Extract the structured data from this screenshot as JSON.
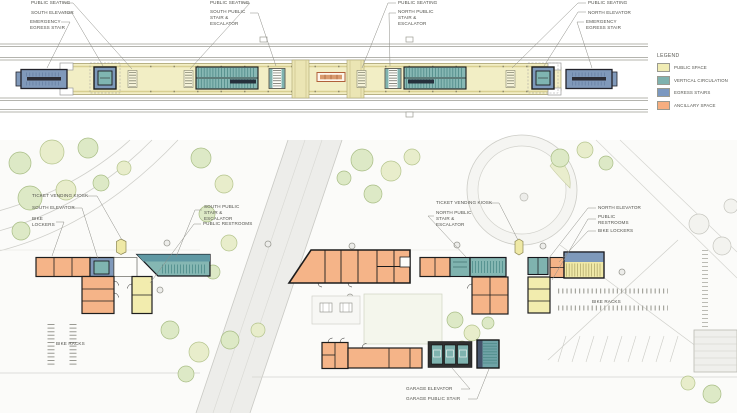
{
  "title": "Transit station plans — platform level and street level",
  "legend": {
    "title": "LEGEND",
    "items": [
      {
        "label": "PUBLIC SPACE",
        "color": "#f0ecb4"
      },
      {
        "label": "VERTICAL CIRCULATION",
        "color": "#7fb2ae"
      },
      {
        "label": "EGRESS STAIRS",
        "color": "#7b98c0"
      },
      {
        "label": "ANCILLARY SPACE",
        "color": "#f6ae80"
      }
    ]
  },
  "colors": {
    "public_space": "#f2eec5",
    "vertical_circulation": "#85b7b3",
    "egress_stairs": "#7e99ba",
    "ancillary_space": "#f5b488"
  },
  "platform_plan": {
    "labels": {
      "public_seating_sw": "PUBLIC SEATING",
      "south_elevator": "SOUTH ELEVATOR",
      "emergency_egress_south": "EMERGENCY EGRESS STAIR",
      "public_seating_s": "PUBLIC SEATING",
      "south_stair": "SOUTH PUBLIC STAIR & ESCALATOR",
      "public_seating_n": "PUBLIC SEATING",
      "north_stair": "NORTH PUBLIC STAIR & ESCALATOR",
      "public_seating_ne": "PUBLIC SEATING",
      "north_elevator": "NORTH ELEVATOR",
      "emergency_egress_north": "EMERGENCY EGRESS STAIR"
    }
  },
  "site_plan": {
    "labels": {
      "ticket_kiosk_south": "TICKET VENDING KIOSK",
      "south_elevator": "SOUTH ELEVATOR",
      "bike_lockers_south": "BIKE LOCKERS",
      "south_stair": "SOUTH PUBLIC STAIR & ESCALATOR",
      "public_restrooms_south": "PUBLIC RESTROOMS",
      "ticket_kiosk_north": "TICKET VENDING KIOSK",
      "north_stair": "NORTH PUBLIC STAIR & ESCALATOR",
      "north_elevator": "NORTH ELEVATOR",
      "public_restrooms_north": "PUBLIC RESTROOMS",
      "bike_lockers_north": "BIKE LOCKERS",
      "bike_racks_south": "BIKE RACKS",
      "bike_racks_north": "BIKE RACKS",
      "garage_elevator": "GARAGE ELEVATOR",
      "garage_stair": "GARAGE PUBLIC STAIR"
    }
  }
}
